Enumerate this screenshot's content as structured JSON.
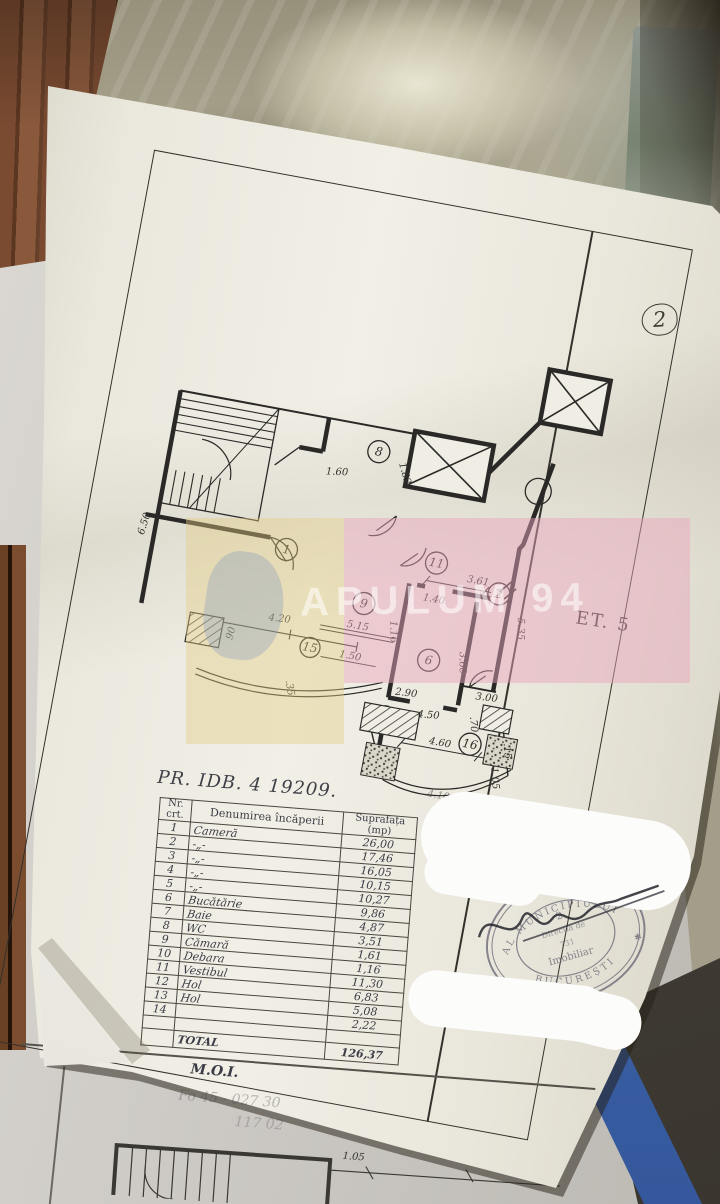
{
  "page": {
    "circled_number": "2",
    "floor_label": "ET. 5",
    "title": "PR. IDB. 4 19209.",
    "moi": "M.O.I.",
    "faded_line1": "Fo 45 - 027 30",
    "faded_line2": "117 02"
  },
  "watermark": {
    "text": "APULUM 94",
    "pink_color": "#e8a6bc",
    "yellow_color": "#e2ce82",
    "logo": "blue-agency-logo"
  },
  "plan": {
    "rooms": [
      "1",
      "11",
      "8",
      "9",
      "2",
      "6",
      "15",
      "16"
    ],
    "dims": [
      "6.50",
      "4.20",
      "90",
      "1.60",
      "1.82",
      "1.40",
      "3.61",
      "1.16",
      "5.15",
      "1.50",
      ".35",
      "5.35",
      "3.60",
      "2.90",
      "4.50",
      "3.00",
      ".70",
      "4.60",
      ".15",
      "1.05",
      "4.10"
    ]
  },
  "table": {
    "headers": [
      "Nr. crt.",
      "Denumirea încăperii",
      "Suprafața (mp)"
    ],
    "rows": [
      {
        "nr": "1",
        "name": "Cameră",
        "mp": "26,00"
      },
      {
        "nr": "2",
        "name": "-„-",
        "mp": "17,46"
      },
      {
        "nr": "3",
        "name": "-„-",
        "mp": "16,05"
      },
      {
        "nr": "4",
        "name": "-„-",
        "mp": "10,15"
      },
      {
        "nr": "5",
        "name": "-„-",
        "mp": "10,27"
      },
      {
        "nr": "6",
        "name": "Bucătărie",
        "mp": "9,86"
      },
      {
        "nr": "7",
        "name": "Baie",
        "mp": "4,87"
      },
      {
        "nr": "8",
        "name": "WC",
        "mp": "3,51"
      },
      {
        "nr": "9",
        "name": "Cămară",
        "mp": "1,61"
      },
      {
        "nr": "10",
        "name": "Debara",
        "mp": "1,16"
      },
      {
        "nr": "11",
        "name": "Vestibul",
        "mp": "11,30"
      },
      {
        "nr": "12",
        "name": "Hol",
        "mp": "6,83"
      },
      {
        "nr": "13",
        "name": "Hol",
        "mp": "5,08"
      },
      {
        "nr": "14",
        "name": "",
        "mp": "2,22"
      },
      {
        "nr": "",
        "name": "",
        "mp": ""
      }
    ],
    "total_label": "TOTAL",
    "total_value": "126,37"
  },
  "stamp": {
    "ring_text_top": "AL MUNICIPIULUI",
    "ring_text_bottom": "BUCUREȘTI",
    "center_line1": "2",
    "center_line2": "Direcția de",
    "center_line3": "731",
    "center_line4": "Imobiliar",
    "star": "✱",
    "ink_color": "#6c6a78"
  },
  "sheet2": {
    "dims": [
      "1.05",
      "1.30"
    ]
  }
}
